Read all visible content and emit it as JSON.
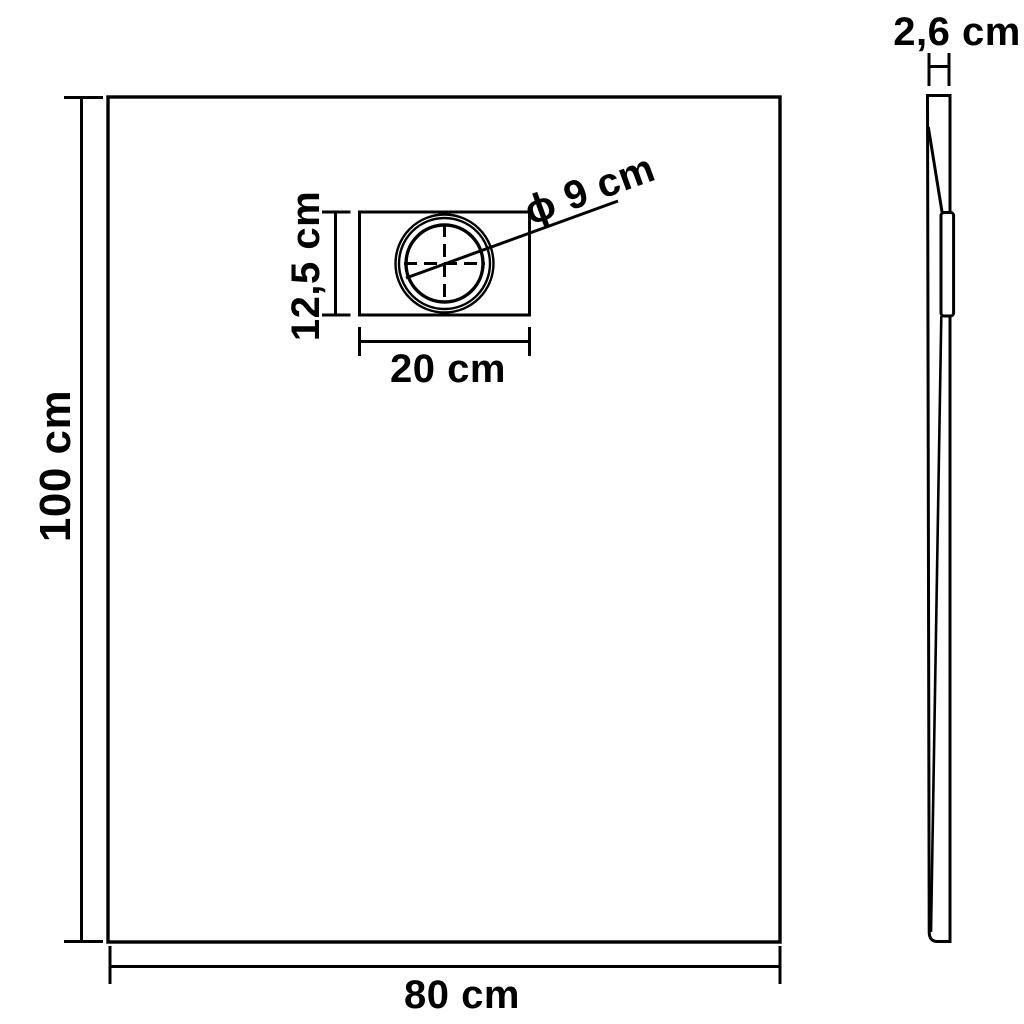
{
  "canvas": {
    "background_color": "#ffffff",
    "line_color": "#000000",
    "text_color": "#000000"
  },
  "views": {
    "front": {
      "height": {
        "label": "100 cm",
        "value": "100",
        "unit": "cm"
      },
      "width": {
        "label": "80 cm",
        "value": "80",
        "unit": "cm"
      },
      "drain": {
        "height": {
          "label": "12,5 cm",
          "value": "12,5",
          "unit": "cm"
        },
        "width": {
          "label": "20 cm",
          "value": "20",
          "unit": "cm"
        },
        "diameter": {
          "label": "ϕ 9 cm",
          "value": "9",
          "unit": "cm"
        }
      }
    },
    "side": {
      "thickness": {
        "label": "2,6 cm",
        "value": "2,6",
        "unit": "cm"
      }
    }
  }
}
